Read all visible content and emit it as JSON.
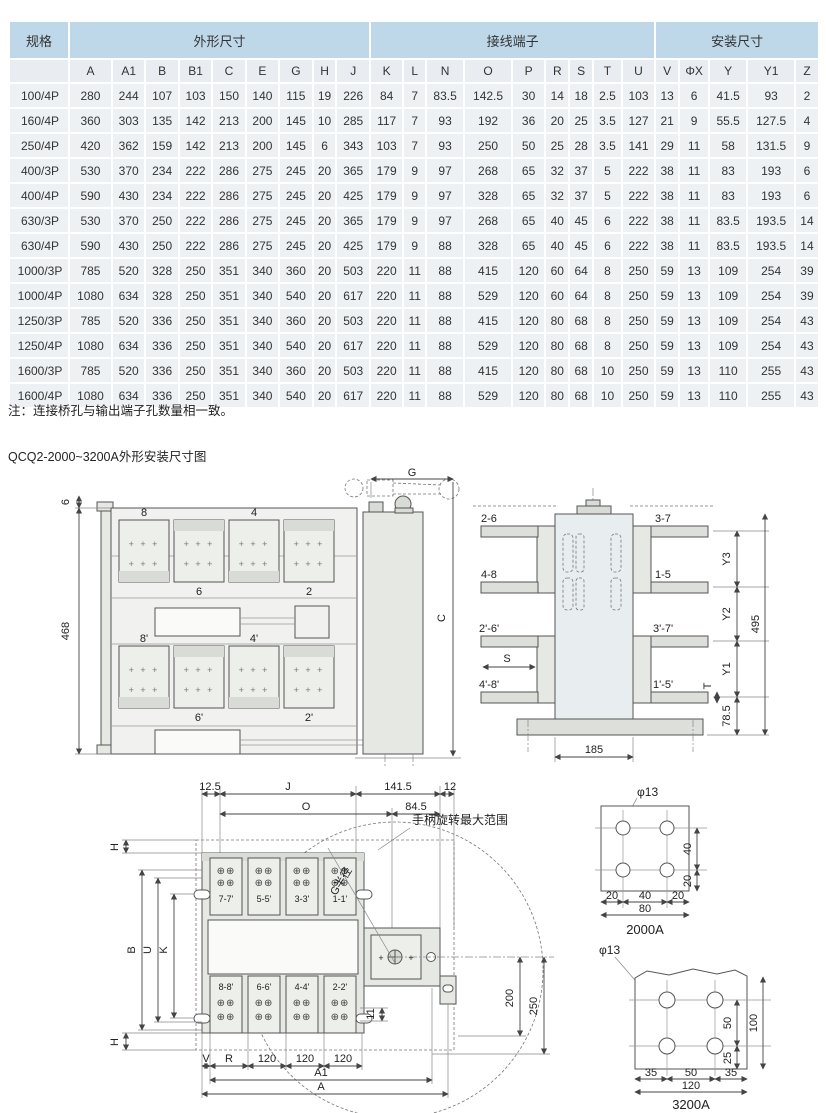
{
  "page": {
    "note": "注：连接桥孔与输出端子孔数量相一致。",
    "title": "QCQ2-2000~3200A外形安装尺寸图"
  },
  "colors": {
    "header_blue": "#bed8ea",
    "subheader": "#e9edf2",
    "cell": "#eef1f4"
  },
  "table": {
    "col_groups": [
      {
        "label": "规格",
        "span": 1
      },
      {
        "label": "外形尺寸",
        "span": 9
      },
      {
        "label": "接线端子",
        "span": 9
      },
      {
        "label": "安装尺寸",
        "span": 5
      }
    ],
    "columns": [
      "A",
      "A1",
      "B",
      "B1",
      "C",
      "E",
      "G",
      "H",
      "J",
      "K",
      "L",
      "N",
      "O",
      "P",
      "R",
      "S",
      "T",
      "U",
      "V",
      "ΦX",
      "Y",
      "Y1",
      "Z"
    ],
    "rows": [
      {
        "spec": "100/4P",
        "values": [
          280,
          244,
          107,
          103,
          150,
          140,
          115,
          19,
          226,
          84,
          7,
          83.5,
          142.5,
          30,
          14,
          18,
          2.5,
          103,
          13,
          6,
          41.5,
          93,
          2
        ]
      },
      {
        "spec": "160/4P",
        "values": [
          360,
          303,
          135,
          142,
          213,
          200,
          145,
          10,
          285,
          117,
          7,
          93,
          192,
          36,
          20,
          25,
          3.5,
          127,
          21,
          9,
          55.5,
          127.5,
          4
        ]
      },
      {
        "spec": "250/4P",
        "values": [
          420,
          362,
          159,
          142,
          213,
          200,
          145,
          6,
          343,
          103,
          7,
          93,
          250,
          50,
          25,
          28,
          3.5,
          141,
          29,
          11,
          58,
          131.5,
          9
        ]
      },
      {
        "spec": "400/3P",
        "values": [
          530,
          370,
          234,
          222,
          286,
          275,
          245,
          20,
          365,
          179,
          9,
          97,
          268,
          65,
          32,
          37,
          5,
          222,
          38,
          11,
          83,
          193,
          6
        ]
      },
      {
        "spec": "400/4P",
        "values": [
          590,
          430,
          234,
          222,
          286,
          275,
          245,
          20,
          425,
          179,
          9,
          97,
          328,
          65,
          32,
          37,
          5,
          222,
          38,
          11,
          83,
          193,
          6
        ]
      },
      {
        "spec": "630/3P",
        "values": [
          530,
          370,
          250,
          222,
          286,
          275,
          245,
          20,
          365,
          179,
          9,
          97,
          268,
          65,
          40,
          45,
          6,
          222,
          38,
          11,
          83.5,
          193.5,
          14
        ]
      },
      {
        "spec": "630/4P",
        "values": [
          590,
          430,
          250,
          222,
          286,
          275,
          245,
          20,
          425,
          179,
          9,
          88,
          328,
          65,
          40,
          45,
          6,
          222,
          38,
          11,
          83.5,
          193.5,
          14
        ]
      },
      {
        "spec": "1000/3P",
        "values": [
          785,
          520,
          328,
          250,
          351,
          340,
          360,
          20,
          503,
          220,
          11,
          88,
          415,
          120,
          60,
          64,
          8,
          250,
          59,
          13,
          109,
          254,
          39
        ]
      },
      {
        "spec": "1000/4P",
        "values": [
          1080,
          634,
          328,
          250,
          351,
          340,
          540,
          20,
          617,
          220,
          11,
          88,
          529,
          120,
          60,
          64,
          8,
          250,
          59,
          13,
          109,
          254,
          39
        ]
      },
      {
        "spec": "1250/3P",
        "values": [
          785,
          520,
          336,
          250,
          351,
          340,
          360,
          20,
          503,
          220,
          11,
          88,
          415,
          120,
          80,
          68,
          8,
          250,
          59,
          13,
          109,
          254,
          43
        ]
      },
      {
        "spec": "1250/4P",
        "values": [
          1080,
          634,
          336,
          250,
          351,
          340,
          540,
          20,
          617,
          220,
          11,
          88,
          529,
          120,
          80,
          68,
          8,
          250,
          59,
          13,
          109,
          254,
          43
        ]
      },
      {
        "spec": "1600/3P",
        "values": [
          785,
          520,
          336,
          250,
          351,
          340,
          360,
          20,
          503,
          220,
          11,
          88,
          415,
          120,
          80,
          68,
          10,
          250,
          59,
          13,
          110,
          255,
          43
        ]
      },
      {
        "spec": "1600/4P",
        "values": [
          1080,
          634,
          336,
          250,
          351,
          340,
          540,
          20,
          617,
          220,
          11,
          88,
          529,
          120,
          80,
          68,
          10,
          250,
          59,
          13,
          110,
          255,
          43
        ]
      }
    ]
  },
  "d1": {
    "dim_6": "6",
    "dim_468": "468",
    "dim_g": "G",
    "dim_c": "C",
    "t8": "8",
    "t4": "4",
    "t6": "6",
    "t2": "2",
    "t8p": "8'",
    "t4p": "4'",
    "t6p": "6'",
    "t2p": "2'",
    "plus": "+ + +"
  },
  "d2": {
    "l_top": "2-6",
    "r_top": "3-7",
    "l2": "4-8",
    "r2": "1-5",
    "l3": "2'-6'",
    "r3": "3'-7'",
    "s": "S",
    "l4": "4'-8'",
    "r4": "1'-5'",
    "y3": "Y3",
    "y2": "Y2",
    "y1": "Y1",
    "t": "T",
    "d785": "78.5",
    "d495": "495",
    "d185": "185"
  },
  "d3": {
    "d125": "12.5",
    "dj": "J",
    "d1415": "141.5",
    "d12": "12",
    "do": "O",
    "d845": "84.5",
    "handle_note": "手柄旋转最大范围",
    "g_radius": "G半径",
    "h_top": "H",
    "b": "B",
    "u": "U",
    "k": "K",
    "h_bot": "H",
    "t1": "7-7'",
    "t2": "5-5'",
    "t3": "3-3'",
    "t4": "1-1'",
    "t5": "8-8'",
    "t6": "6-6'",
    "t7": "4-4'",
    "t8": "2-2'",
    "d200": "200",
    "d250": "250",
    "d11": "11",
    "dv": "V",
    "dr": "R",
    "d120": "120",
    "da1": "A1",
    "da": "A",
    "screw": "⊕⊕"
  },
  "d4": {
    "phi": "φ13",
    "h1": "20",
    "h2": "40",
    "h3": "20",
    "w": "80",
    "v1": "40",
    "v2": "20",
    "caption": "2000A"
  },
  "d5": {
    "phi": "φ13",
    "h1": "35",
    "h2": "50",
    "h3": "35",
    "w": "120",
    "v1": "50",
    "v2": "25",
    "v3": "100",
    "caption": "3200A"
  }
}
